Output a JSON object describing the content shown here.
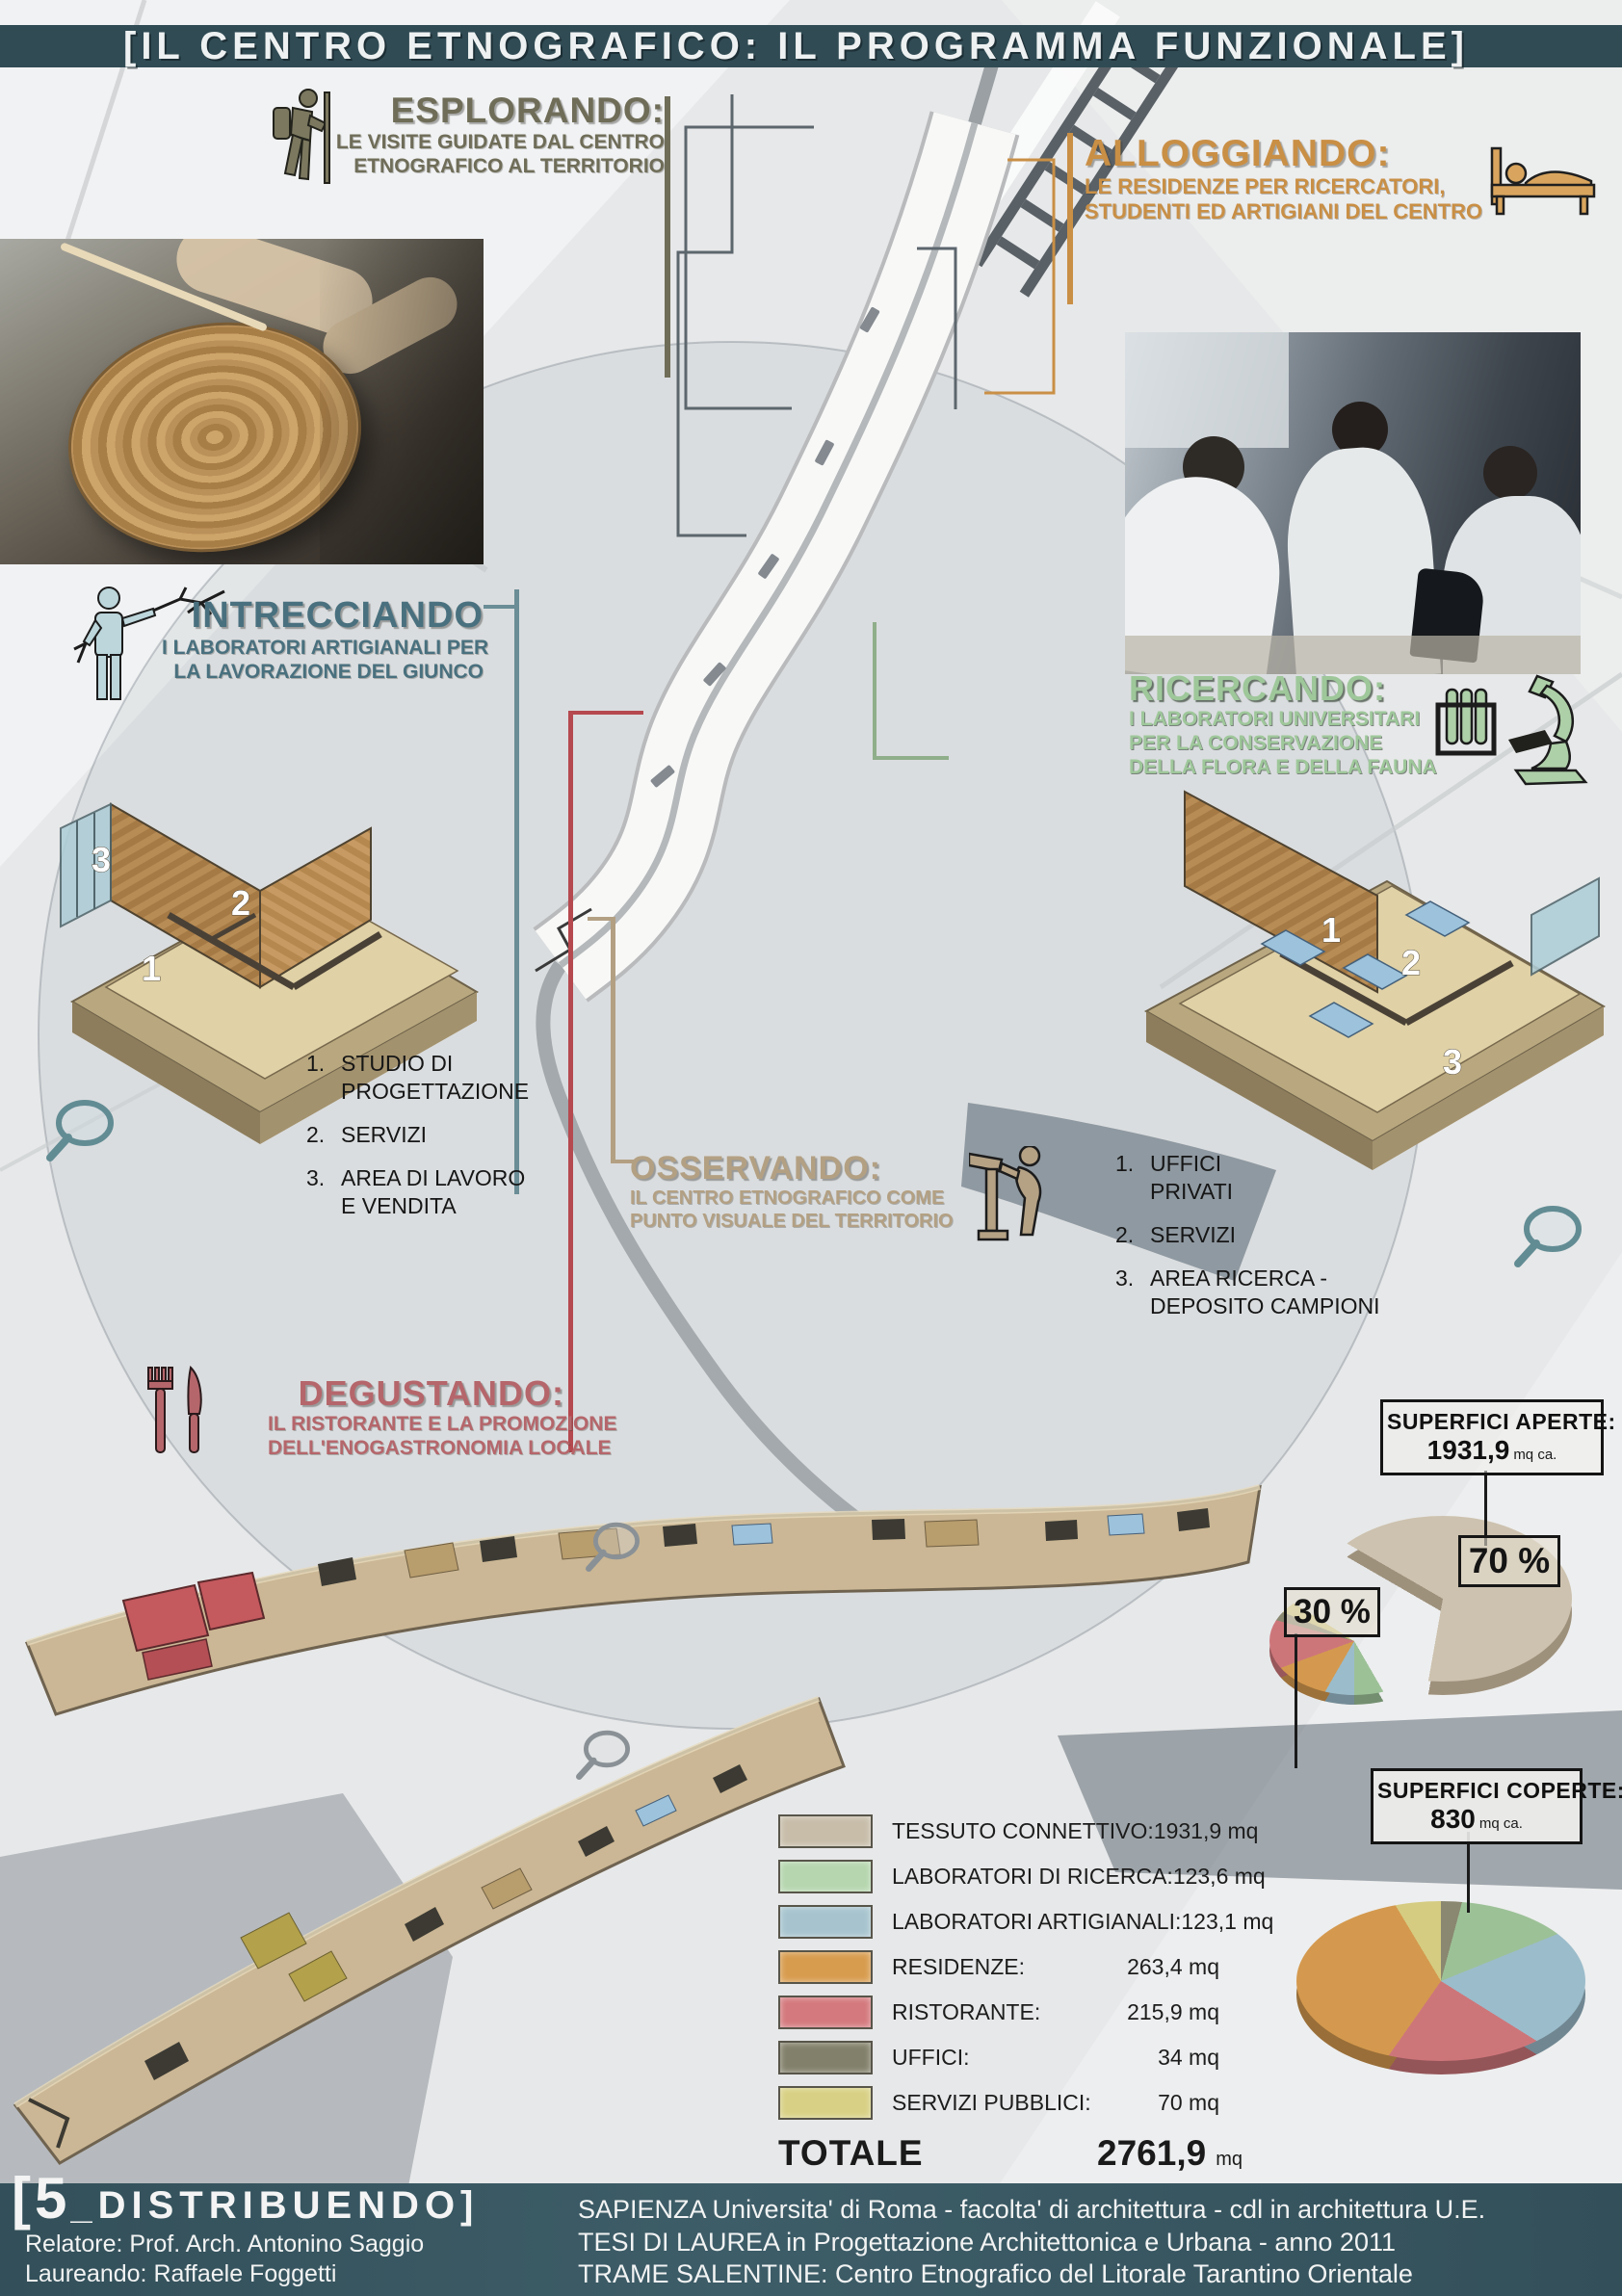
{
  "title": "[IL CENTRO ETNOGRAFICO: IL PROGRAMMA FUNZIONALE]",
  "colors": {
    "band": "#304b54",
    "esplorando": "#6f6d58",
    "alloggiando": "#c98f45",
    "intrecciando": "#49707e",
    "ricercando": "#9ec79a",
    "osservando": "#b3a083",
    "degustando": "#b5666b"
  },
  "sections": {
    "esplorando": {
      "heading": "ESPLORANDO:",
      "lines": [
        "LE VISITE GUIDATE DAL CENTRO",
        "ETNOGRAFICO AL TERRITORIO"
      ]
    },
    "alloggiando": {
      "heading": "ALLOGGIANDO:",
      "lines": [
        "LE RESIDENZE PER RICERCATORI,",
        "STUDENTI ED ARTIGIANI DEL CENTRO"
      ]
    },
    "intrecciando": {
      "heading": "INTRECCIANDO",
      "lines": [
        "I LABORATORI ARTIGIANALI PER",
        "LA LAVORAZIONE DEL GIUNCO"
      ]
    },
    "ricercando": {
      "heading": "RICERCANDO:",
      "lines": [
        "I LABORATORI UNIVERSITARI",
        "PER LA CONSERVAZIONE",
        "DELLA FLORA E DELLA FAUNA"
      ]
    },
    "osservando": {
      "heading": "OSSERVANDO:",
      "lines": [
        "IL CENTRO ETNOGRAFICO COME",
        "PUNTO VISUALE DEL TERRITORIO"
      ]
    },
    "degustando": {
      "heading": "DEGUSTANDO:",
      "lines": [
        "IL RISTORANTE E LA PROMOZIONE",
        "DELL'ENOGASTRONOMIA LOCALE"
      ]
    }
  },
  "room_lists": {
    "left": [
      {
        "num": "1.",
        "lines": [
          "STUDIO DI",
          "PROGETTAZIONE"
        ]
      },
      {
        "num": "2.",
        "lines": [
          "SERVIZI"
        ]
      },
      {
        "num": "3.",
        "lines": [
          "AREA DI LAVORO",
          "E VENDITA"
        ]
      }
    ],
    "right": [
      {
        "num": "1.",
        "lines": [
          "UFFICI",
          "PRIVATI"
        ]
      },
      {
        "num": "2.",
        "lines": [
          "SERVIZI"
        ]
      },
      {
        "num": "3.",
        "lines": [
          "AREA RICERCA -",
          "DEPOSITO CAMPIONI"
        ]
      }
    ]
  },
  "axons": {
    "left": [
      "3",
      "2",
      "1"
    ],
    "right": [
      "1",
      "2",
      "3"
    ]
  },
  "surface_boxes": {
    "aperte": {
      "title": "SUPERFICI APERTE:",
      "value": "1931,9",
      "unit": "mq ca."
    },
    "coperte": {
      "title": "SUPERFICI COPERTE:",
      "value": "830",
      "unit": "mq ca."
    }
  },
  "pie_labels": {
    "open": "70 %",
    "covered": "30 %"
  },
  "legend": {
    "rows": [
      {
        "label": "TESSUTO CONNETTIVO:",
        "value": "1931,9 mq",
        "color": "#c7bda9"
      },
      {
        "label": "LABORATORI DI RICERCA:",
        "value": "123,6 mq",
        "color": "#b5d6ae"
      },
      {
        "label": "LABORATORI ARTIGIANALI:",
        "value": "123,1 mq",
        "color": "#a7c4ce"
      },
      {
        "label": "RESIDENZE:",
        "value": "263,4 mq",
        "color": "#d89c4e"
      },
      {
        "label": "RISTORANTE:",
        "value": "215,9 mq",
        "color": "#d4797d"
      },
      {
        "label": "UFFICI:",
        "value": "34 mq",
        "color": "#82806a"
      },
      {
        "label": "SERVIZI PUBBLICI:",
        "value": "70 mq",
        "color": "#d8d084"
      }
    ],
    "total_label": "TOTALE",
    "total_value": "2761,9",
    "total_unit": "mq"
  },
  "footer": {
    "series_prefix": "[5",
    "series_rest": "_DISTRIBUENDO]",
    "relatore": "Relatore: Prof. Arch. Antonino Saggio",
    "laureando": "Laureando: Raffaele Foggetti",
    "line1": "SAPIENZA Universita' di Roma - facolta' di architettura - cdl in architettura U.E.",
    "line2": "TESI DI LAUREA in Progettazione Architettonica e Urbana - anno 2011",
    "line3": "TRAME SALENTINE: Centro Etnografico del Litorale Tarantino Orientale"
  },
  "chart_data": [
    {
      "type": "pie",
      "title": "Superfici aperte vs superfici coperte",
      "labels": [
        "SUPERFICI APERTE",
        "SUPERFICI COPERTE"
      ],
      "values": [
        70,
        30
      ],
      "unit": "%",
      "annotations": [
        "70 %",
        "30 %",
        "SUPERFICI APERTE: 1931,9 mq ca.",
        "SUPERFICI COPERTE: 830 mq ca."
      ]
    },
    {
      "type": "pie",
      "title": "Superfici coperte - 830 mq ca.",
      "labels": [
        "LABORATORI DI RICERCA",
        "LABORATORI ARTIGIANALI",
        "RESIDENZE",
        "RISTORANTE",
        "UFFICI",
        "SERVIZI PUBBLICI"
      ],
      "values": [
        123.6,
        123.1,
        263.4,
        215.9,
        34,
        70
      ],
      "unit": "mq"
    },
    {
      "type": "table",
      "title": "Programma funzionale - superfici",
      "rows": [
        [
          "TESSUTO CONNETTIVO:",
          "1931,9 mq"
        ],
        [
          "LABORATORI DI RICERCA:",
          "123,6 mq"
        ],
        [
          "LABORATORI ARTIGIANALI:",
          "123,1 mq"
        ],
        [
          "RESIDENZE:",
          "263,4 mq"
        ],
        [
          "RISTORANTE:",
          "215,9 mq"
        ],
        [
          "UFFICI:",
          "34 mq"
        ],
        [
          "SERVIZI PUBBLICI:",
          "70 mq"
        ],
        [
          "TOTALE",
          "2761,9 mq"
        ]
      ]
    }
  ]
}
